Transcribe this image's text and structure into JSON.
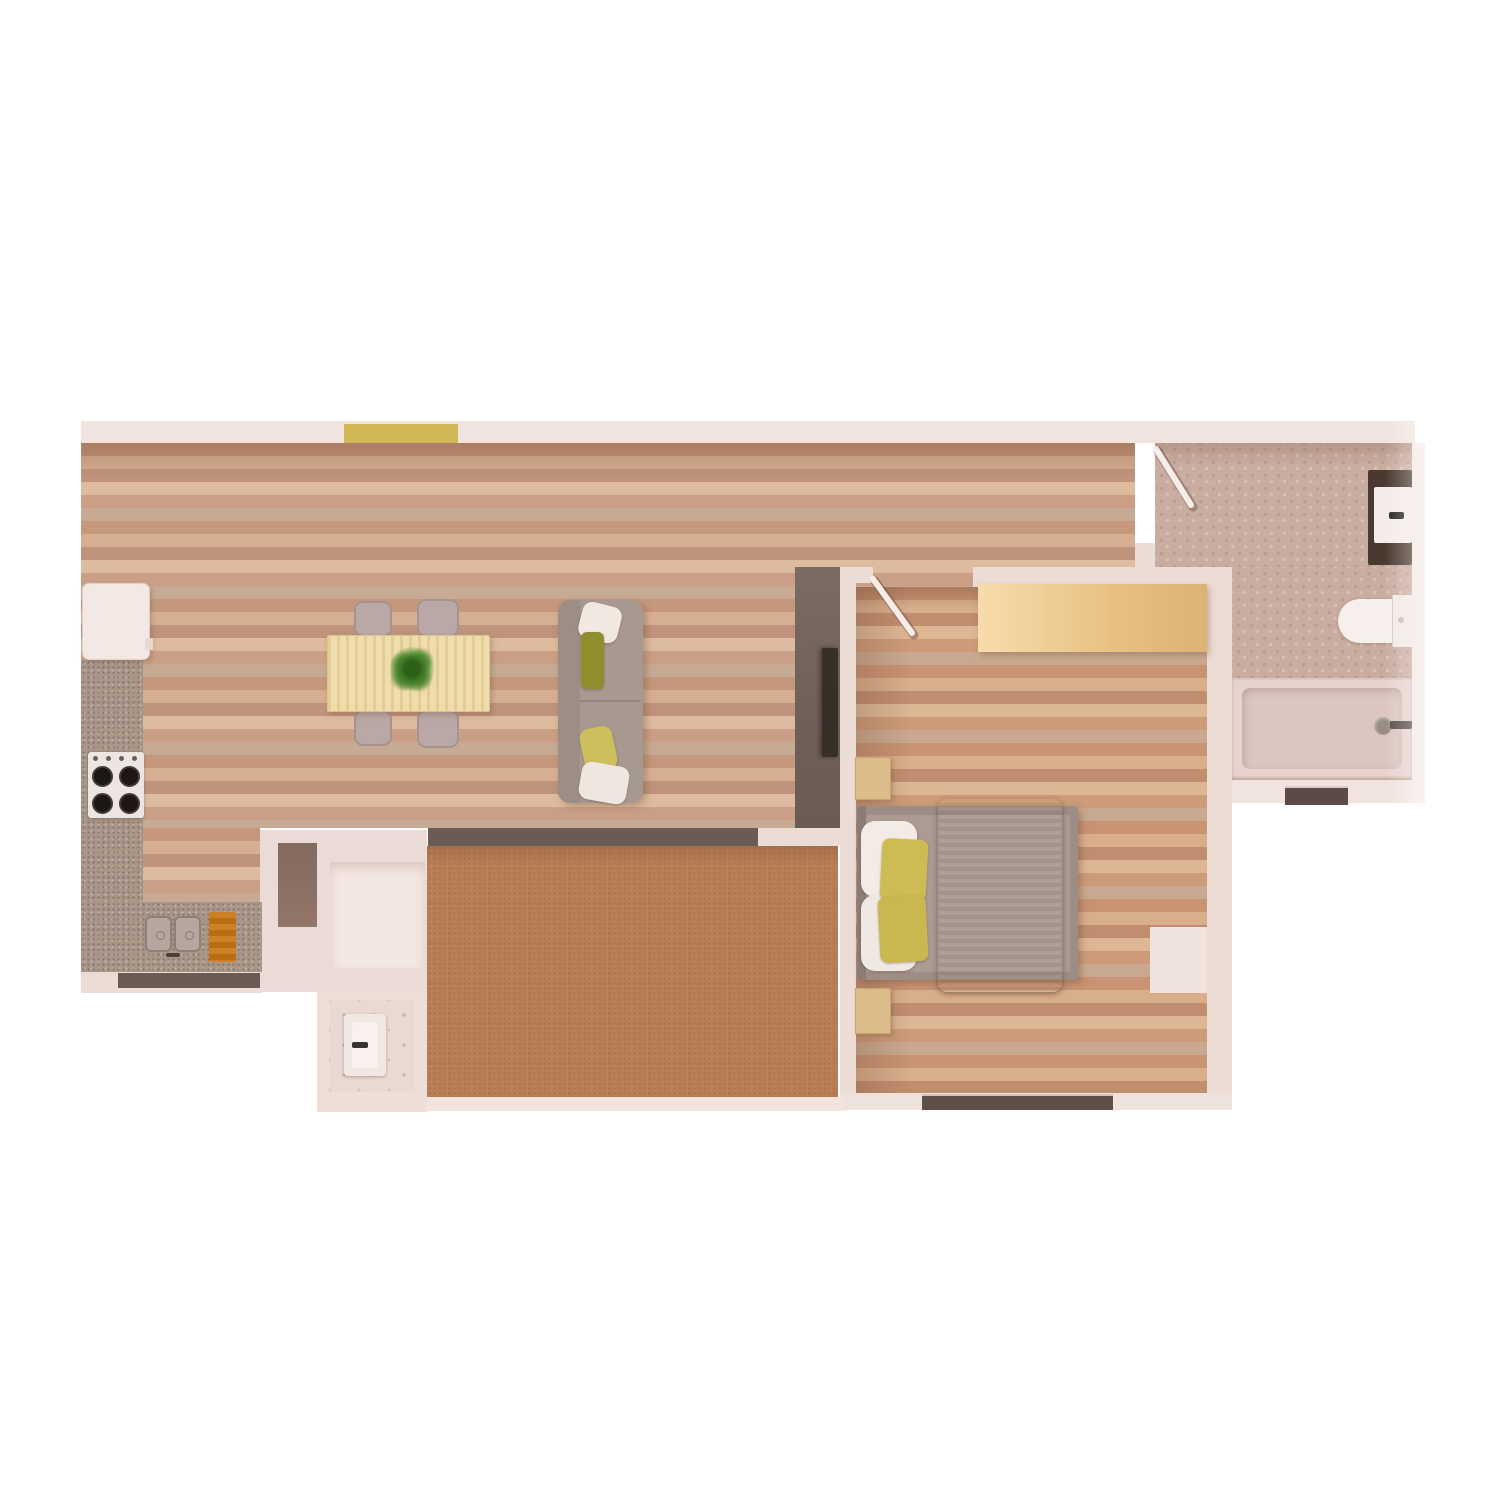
{
  "meta": {
    "title": "Apartment floor plan — top-down 3D render",
    "view": "top-down",
    "style": "photorealistic render, no text labels"
  },
  "palette": {
    "background": "#ffffff",
    "wall": "#ecdcd6",
    "wall_accent_yellow": "#d2b756",
    "living_floor_wood": "#cfa184",
    "bedroom_floor_wood": "#d0a07a",
    "terrace_floor_cork": "#b97e55",
    "bathroom_tile": "#c9ada1",
    "kitchen_counter_granite": "#a99689",
    "tv_partition_concrete": "#72635a",
    "tv_screen": "#382f28",
    "bed_blanket": "#453931",
    "pillow_yellow": "#cdbb54",
    "pillow_olive": "#8f8e2e",
    "pillow_white": "#f2ebe4",
    "sofa_fabric": "#a79890",
    "dining_table_wood": "#ecd8a4",
    "desk_wood": "#eec98b",
    "nightstand_wood": "#dcbc88",
    "cutting_board_orange": "#c87a1e",
    "dark_window_glass": "#5f4f49",
    "plant_green": "#3f7a26",
    "vanity_cabinet_brown": "#4a392f",
    "fixture_white": "#f4ece8"
  },
  "rooms": {
    "living": {
      "label": "living room"
    },
    "kitchen": {
      "label": "kitchen"
    },
    "dining": {
      "label": "dining area"
    },
    "bedroom": {
      "label": "bedroom"
    },
    "bathroom": {
      "label": "bathroom"
    },
    "terrace": {
      "label": "terrace"
    },
    "storage": {
      "label": "storage room"
    },
    "utility": {
      "label": "utility room with washbasin"
    }
  },
  "furniture": {
    "fridge": {
      "label": "refrigerator cabinet"
    },
    "counter": {
      "label": "kitchen counter"
    },
    "stove": {
      "label": "cooktop with four burners"
    },
    "sink": {
      "label": "double kitchen sink"
    },
    "board": {
      "label": "cutting board"
    },
    "table": {
      "label": "dining table"
    },
    "chair": {
      "label": "dining chair"
    },
    "plant": {
      "label": "potted plant centerpiece"
    },
    "sofa": {
      "label": "sofa with cushions"
    },
    "tv_wall": {
      "label": "tv partition wall"
    },
    "tv": {
      "label": "wall-mounted tv"
    },
    "desk": {
      "label": "bedroom desk / wardrobe top"
    },
    "nightstand": {
      "label": "nightstand"
    },
    "bed": {
      "label": "double bed"
    },
    "blanket": {
      "label": "bed blanket"
    },
    "vanity": {
      "label": "bathroom vanity with sink"
    },
    "toilet": {
      "label": "toilet"
    },
    "bathtub": {
      "label": "bathtub with shower head"
    },
    "washbasin": {
      "label": "utility washbasin"
    },
    "entry_door": {
      "label": "entry door leaf (open)"
    },
    "bedroom_door": {
      "label": "bedroom door leaf (open)"
    },
    "sliding_door": {
      "label": "terrace sliding glass door"
    },
    "window": {
      "label": "window"
    }
  }
}
